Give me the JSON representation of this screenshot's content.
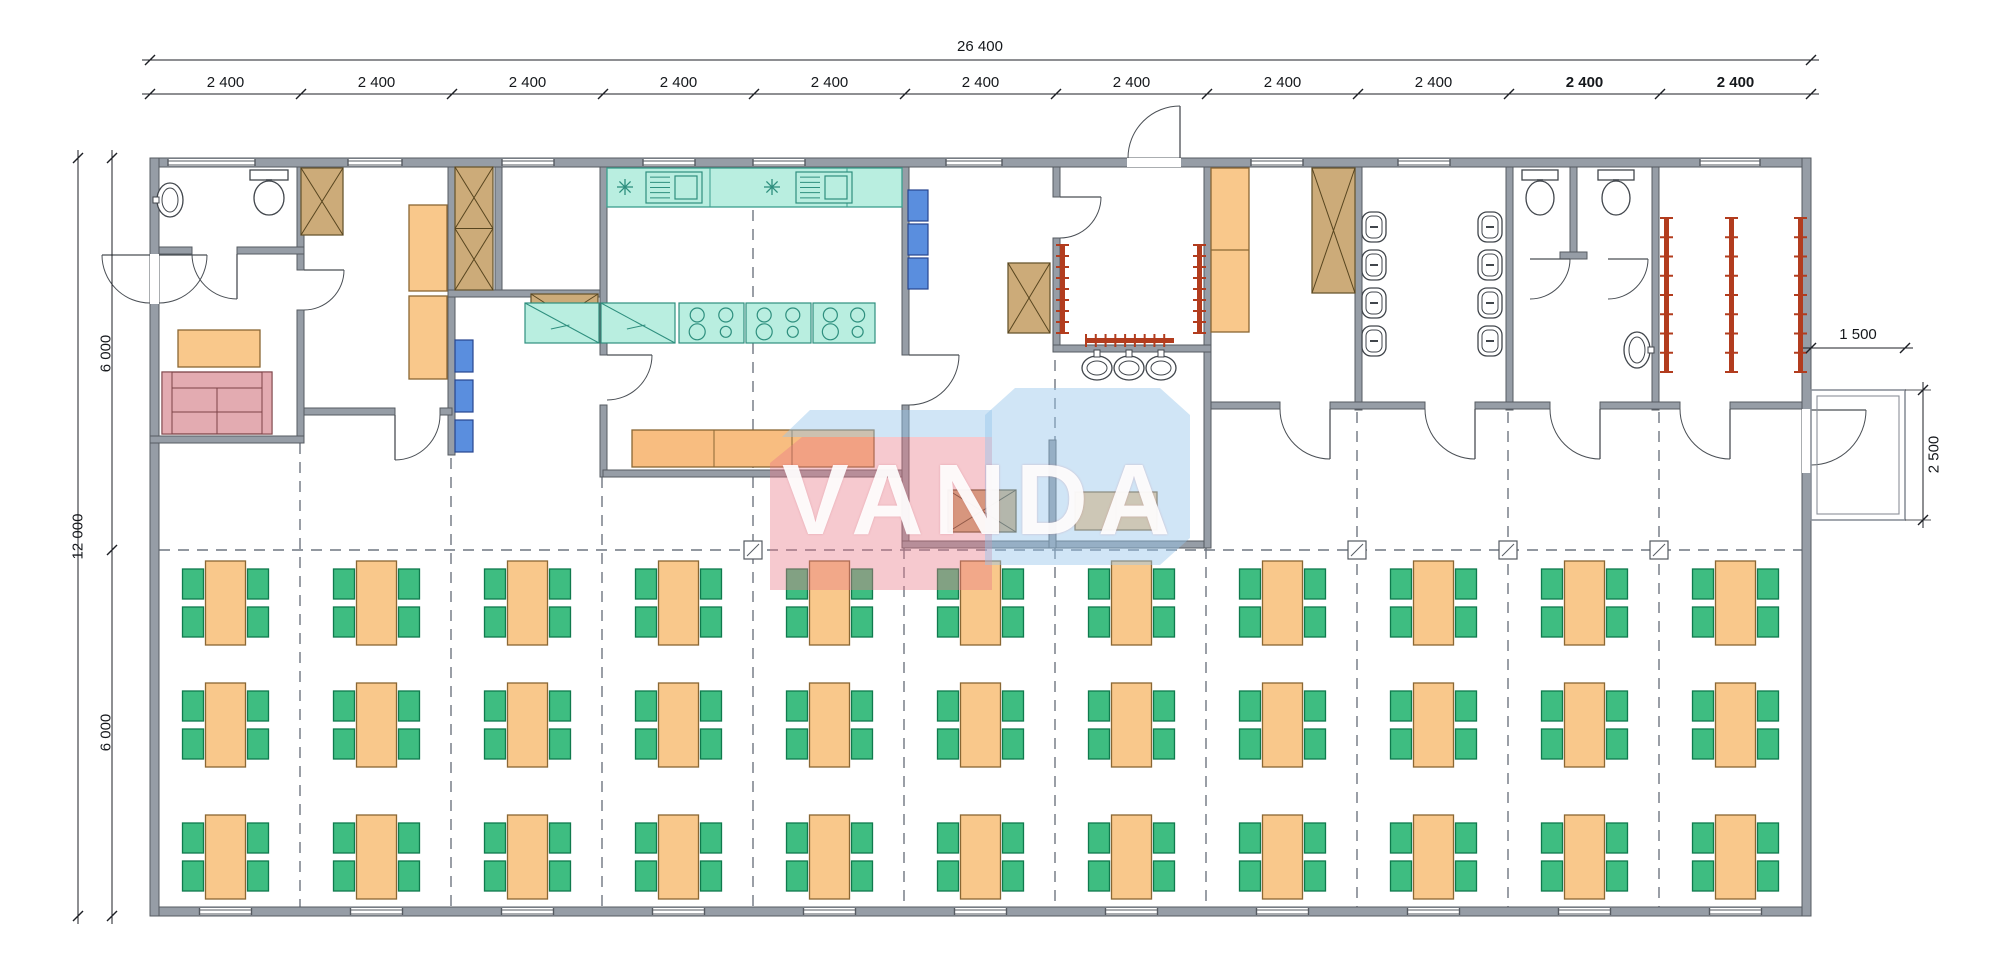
{
  "watermark": {
    "text": "VANDA",
    "pink": "rgba(233,120,135,0.40)",
    "blue": "rgba(150,198,236,0.45)"
  },
  "dimensions": {
    "overall_width_mm": "26 400",
    "overall_height_mm": "12 000",
    "height_halves": [
      "6 000",
      "6 000"
    ],
    "bays": [
      {
        "label": "2 400",
        "bold": false
      },
      {
        "label": "2 400",
        "bold": false
      },
      {
        "label": "2 400",
        "bold": false
      },
      {
        "label": "2 400",
        "bold": false
      },
      {
        "label": "2 400",
        "bold": false
      },
      {
        "label": "2 400",
        "bold": false
      },
      {
        "label": "2 400",
        "bold": false
      },
      {
        "label": "2 400",
        "bold": false
      },
      {
        "label": "2 400",
        "bold": false
      },
      {
        "label": "2 400",
        "bold": true
      },
      {
        "label": "2 400",
        "bold": true
      }
    ],
    "porch": {
      "width_mm": "1 500",
      "depth_mm": "2 500"
    }
  },
  "dining": {
    "columns": 11,
    "rows": 3,
    "tables": 33,
    "chairs_per_table": 4,
    "total_seats": 132,
    "col_start": 225.5,
    "col_step": 151,
    "row_centers": [
      603,
      725,
      857
    ]
  },
  "colors": {
    "wall": "#969da6",
    "wall_edge": "#565b62",
    "dash": "#6f7680",
    "dim": "#1c1f24",
    "table": "#f9c88b",
    "table_edge": "#8a6733",
    "chair": "#3ebd81",
    "chair_edge": "#0f7a4d",
    "kitchen": "#b9eee0",
    "kitchen_edge": "#3b9f8e",
    "cabinet": "#ccab79",
    "cabinet_edge": "#6a5831",
    "shelf": "#5a8ede",
    "shelf_edge": "#27458f",
    "sofa": "#e3abb1",
    "sofa_edge": "#7d4348",
    "rack": "#b23c1e",
    "fixture": "#41464c",
    "counter_serve": "#f8bd80"
  },
  "legend": {
    "wall": "wall",
    "window": "window",
    "door": "door-swing",
    "dash": "grid-axis-line",
    "marker": "column-marker",
    "porch": "entry-porch",
    "cabx": "storage-cabinet-icon",
    "cabxx": "tall-wardrobe-cabinet-icon",
    "tableV": "work-table-icon",
    "tableH": "serving-table-icon",
    "desk": "office-desk-icon",
    "locker2": "locker-cabinet-icon",
    "shelf": "shelf-unit-icon",
    "sofa": "sofa-icon",
    "counter": "kitchen-counter-icon",
    "sinkunit": "kitchen-sink-icon",
    "star": "light-symbol-icon",
    "fridge": "refrigerator-icon",
    "stove": "cooktop-4-burner-icon",
    "counter3": "serving-counter-icon",
    "wc": "toilet-icon",
    "sink": "washbasin-icon",
    "basin": "washbasin-icon",
    "basinV": "washbasin-icon",
    "urinal": "urinal-icon",
    "rackV": "coat-rack-icon",
    "rackH": "coat-rack-icon",
    "dining_table": "dining-table-icon",
    "dining_chair": "chair-icon"
  },
  "plan": {
    "walls": [
      [
        150,
        158,
        1661,
        9
      ],
      [
        150,
        907,
        1661,
        9
      ],
      [
        150,
        158,
        9,
        758
      ],
      [
        1802,
        158,
        9,
        758
      ],
      [
        297,
        167,
        7,
        103
      ],
      [
        297,
        310,
        7,
        133
      ],
      [
        159,
        247,
        33,
        7
      ],
      [
        237,
        247,
        67,
        7
      ],
      [
        150,
        436,
        154,
        7
      ],
      [
        448,
        167,
        7,
        288
      ],
      [
        304,
        408,
        91,
        7
      ],
      [
        440,
        408,
        12,
        7
      ],
      [
        495,
        167,
        7,
        130
      ],
      [
        448,
        290,
        157,
        7
      ],
      [
        600,
        167,
        7,
        188
      ],
      [
        600,
        405,
        7,
        72
      ],
      [
        902,
        167,
        7,
        188
      ],
      [
        902,
        405,
        7,
        143
      ],
      [
        603,
        470,
        299,
        7
      ],
      [
        902,
        541,
        309,
        7
      ],
      [
        1204,
        167,
        7,
        381
      ],
      [
        1049,
        440,
        7,
        108
      ],
      [
        1053,
        345,
        158,
        7
      ],
      [
        1053,
        167,
        7,
        30
      ],
      [
        1053,
        238,
        7,
        107
      ],
      [
        1355,
        167,
        7,
        243
      ],
      [
        1506,
        167,
        7,
        243
      ],
      [
        1570,
        167,
        7,
        92
      ],
      [
        1560,
        252,
        27,
        7
      ],
      [
        1652,
        167,
        7,
        243
      ],
      [
        1211,
        402,
        69,
        7
      ],
      [
        1330,
        402,
        95,
        7
      ],
      [
        1475,
        402,
        75,
        7
      ],
      [
        1600,
        402,
        80,
        7
      ],
      [
        1730,
        402,
        72,
        7
      ]
    ],
    "windows_top": [
      [
        168,
        87
      ],
      [
        348,
        54
      ],
      [
        502,
        52
      ],
      [
        643,
        52
      ],
      [
        753,
        52
      ],
      [
        946,
        56
      ],
      [
        1251,
        52
      ],
      [
        1398,
        52
      ],
      [
        1700,
        60
      ]
    ],
    "gaps": [
      [
        150,
        254,
        9,
        50
      ],
      [
        1802,
        409,
        9,
        64
      ],
      [
        1127,
        158,
        54,
        9
      ]
    ],
    "dashes_v": [
      [
        300,
        443,
        907
      ],
      [
        451,
        420,
        907
      ],
      [
        602,
        477,
        907
      ],
      [
        753,
        210,
        470
      ],
      [
        753,
        477,
        907
      ],
      [
        904,
        548,
        907
      ],
      [
        1055,
        360,
        535
      ],
      [
        1055,
        548,
        907
      ],
      [
        1206,
        548,
        907
      ],
      [
        1357,
        412,
        907
      ],
      [
        1508,
        412,
        907
      ],
      [
        1659,
        412,
        907
      ]
    ],
    "dash_h": [
      550,
      159,
      1802
    ],
    "markers": [
      [
        753,
        550
      ],
      [
        1357,
        550
      ],
      [
        1508,
        550
      ],
      [
        1659,
        550
      ]
    ],
    "doors": [
      {
        "h": [
          159,
          255
        ],
        "a": [
          207,
          255
        ],
        "b": [
          159,
          303
        ],
        "s": 1
      },
      {
        "h": [
          150,
          255
        ],
        "a": [
          102,
          255
        ],
        "b": [
          150,
          303
        ],
        "s": 0
      },
      {
        "h": [
          237,
          254
        ],
        "a": [
          237,
          299
        ],
        "b": [
          192,
          254
        ],
        "s": 1
      },
      {
        "h": [
          304,
          270
        ],
        "a": [
          344,
          270
        ],
        "b": [
          304,
          310
        ],
        "s": 1
      },
      {
        "h": [
          607,
          355
        ],
        "a": [
          652,
          355
        ],
        "b": [
          607,
          400
        ],
        "s": 1
      },
      {
        "h": [
          909,
          355
        ],
        "a": [
          959,
          355
        ],
        "b": [
          909,
          405
        ],
        "s": 1
      },
      {
        "h": [
          1060,
          197
        ],
        "a": [
          1101,
          197
        ],
        "b": [
          1060,
          238
        ],
        "s": 1
      },
      {
        "h": [
          1180,
          158
        ],
        "a": [
          1180,
          106
        ],
        "b": [
          1128,
          158
        ],
        "s": 0
      },
      {
        "h": [
          1330,
          409
        ],
        "a": [
          1330,
          459
        ],
        "b": [
          1280,
          409
        ],
        "s": 1
      },
      {
        "h": [
          1475,
          409
        ],
        "a": [
          1475,
          459
        ],
        "b": [
          1425,
          409
        ],
        "s": 1
      },
      {
        "h": [
          1600,
          409
        ],
        "a": [
          1600,
          459
        ],
        "b": [
          1550,
          409
        ],
        "s": 1
      },
      {
        "h": [
          1730,
          409
        ],
        "a": [
          1730,
          459
        ],
        "b": [
          1680,
          409
        ],
        "s": 1
      },
      {
        "h": [
          1811,
          410
        ],
        "a": [
          1866,
          410
        ],
        "b": [
          1811,
          465
        ],
        "s": 1
      },
      {
        "h": [
          1530,
          259
        ],
        "a": [
          1570,
          259
        ],
        "b": [
          1530,
          299
        ],
        "s": 1
      },
      {
        "h": [
          1608,
          259
        ],
        "a": [
          1648,
          259
        ],
        "b": [
          1608,
          299
        ],
        "s": 1
      },
      {
        "h": [
          395,
          415
        ],
        "a": [
          395,
          460
        ],
        "b": [
          440,
          415
        ],
        "s": 0
      }
    ],
    "furniture": [
      {
        "t": "sink",
        "x": 157,
        "y": 183,
        "w": 26,
        "h": 34
      },
      {
        "t": "wc",
        "x": 250,
        "y": 170,
        "w": 38,
        "h": 46
      },
      {
        "t": "desk",
        "x": 178,
        "y": 330,
        "w": 82,
        "h": 37
      },
      {
        "t": "sofa",
        "x": 162,
        "y": 372,
        "w": 110,
        "h": 62
      },
      {
        "t": "cabx",
        "x": 301,
        "y": 168,
        "w": 42,
        "h": 67
      },
      {
        "t": "tableV",
        "x": 409,
        "y": 205,
        "w": 38,
        "h": 86
      },
      {
        "t": "tableV",
        "x": 409,
        "y": 296,
        "w": 38,
        "h": 83
      },
      {
        "t": "cabxx",
        "x": 455,
        "y": 167,
        "w": 38,
        "h": 123
      },
      {
        "t": "shelf",
        "x": 455,
        "y": 340,
        "w": 18,
        "h": 32
      },
      {
        "t": "shelf",
        "x": 455,
        "y": 380,
        "w": 18,
        "h": 32
      },
      {
        "t": "shelf",
        "x": 455,
        "y": 420,
        "w": 18,
        "h": 32
      },
      {
        "t": "cabx",
        "x": 531,
        "y": 294,
        "w": 67,
        "h": 43
      },
      {
        "t": "counter",
        "x": 607,
        "y": 168,
        "w": 295,
        "h": 39
      },
      {
        "t": "star",
        "x": 617,
        "y": 179,
        "w": 16,
        "h": 16
      },
      {
        "t": "sinkunit",
        "x": 646,
        "y": 172,
        "w": 56,
        "h": 31
      },
      {
        "t": "star",
        "x": 764,
        "y": 179,
        "w": 16,
        "h": 16
      },
      {
        "t": "sinkunit",
        "x": 796,
        "y": 172,
        "w": 56,
        "h": 31
      },
      {
        "t": "fridge",
        "x": 525,
        "y": 303,
        "w": 74,
        "h": 40
      },
      {
        "t": "fridge",
        "x": 601,
        "y": 303,
        "w": 74,
        "h": 40
      },
      {
        "t": "stove",
        "x": 679,
        "y": 303,
        "w": 65,
        "h": 40
      },
      {
        "t": "stove",
        "x": 746,
        "y": 303,
        "w": 65,
        "h": 40
      },
      {
        "t": "stove",
        "x": 813,
        "y": 303,
        "w": 62,
        "h": 40
      },
      {
        "t": "counter3",
        "x": 632,
        "y": 430,
        "w": 242,
        "h": 37
      },
      {
        "t": "shelf",
        "x": 908,
        "y": 190,
        "w": 20,
        "h": 31
      },
      {
        "t": "shelf",
        "x": 908,
        "y": 224,
        "w": 20,
        "h": 31
      },
      {
        "t": "shelf",
        "x": 908,
        "y": 258,
        "w": 20,
        "h": 31
      },
      {
        "t": "cabx",
        "x": 1008,
        "y": 263,
        "w": 42,
        "h": 70
      },
      {
        "t": "cabx",
        "x": 948,
        "y": 490,
        "w": 68,
        "h": 42
      },
      {
        "t": "tableH",
        "x": 1075,
        "y": 492,
        "w": 82,
        "h": 38
      },
      {
        "t": "basin",
        "x": 1082,
        "y": 354,
        "w": 30,
        "h": 24
      },
      {
        "t": "basin",
        "x": 1114,
        "y": 354,
        "w": 30,
        "h": 24
      },
      {
        "t": "basin",
        "x": 1146,
        "y": 354,
        "w": 30,
        "h": 24
      },
      {
        "t": "locker2",
        "x": 1211,
        "y": 168,
        "w": 38,
        "h": 164
      },
      {
        "t": "cabx",
        "x": 1312,
        "y": 168,
        "w": 43,
        "h": 125
      },
      {
        "t": "urinal",
        "x": 1362,
        "y": 212,
        "w": 24,
        "h": 30
      },
      {
        "t": "urinal",
        "x": 1362,
        "y": 250,
        "w": 24,
        "h": 30
      },
      {
        "t": "urinal",
        "x": 1362,
        "y": 288,
        "w": 24,
        "h": 30
      },
      {
        "t": "urinal",
        "x": 1362,
        "y": 326,
        "w": 24,
        "h": 30
      },
      {
        "t": "urinal",
        "x": 1478,
        "y": 212,
        "w": 24,
        "h": 30
      },
      {
        "t": "urinal",
        "x": 1478,
        "y": 250,
        "w": 24,
        "h": 30
      },
      {
        "t": "urinal",
        "x": 1478,
        "y": 288,
        "w": 24,
        "h": 30
      },
      {
        "t": "urinal",
        "x": 1478,
        "y": 326,
        "w": 24,
        "h": 30
      },
      {
        "t": "wc",
        "x": 1522,
        "y": 170,
        "w": 36,
        "h": 46
      },
      {
        "t": "wc",
        "x": 1598,
        "y": 170,
        "w": 36,
        "h": 46
      },
      {
        "t": "basinV",
        "x": 1624,
        "y": 332,
        "w": 26,
        "h": 36
      },
      {
        "t": "rackV",
        "x": 1664,
        "y": 218,
        "w": 5,
        "h": 154
      },
      {
        "t": "rackV",
        "x": 1729,
        "y": 218,
        "w": 5,
        "h": 154
      },
      {
        "t": "rackV",
        "x": 1798,
        "y": 218,
        "w": 5,
        "h": 154
      },
      {
        "t": "rackV",
        "x": 1060,
        "y": 245,
        "w": 5,
        "h": 88
      },
      {
        "t": "rackV",
        "x": 1197,
        "y": 245,
        "w": 5,
        "h": 88
      },
      {
        "t": "rackH",
        "x": 1086,
        "y": 338,
        "w": 88,
        "h": 5
      }
    ],
    "porch": [
      1811,
      390,
      94,
      130
    ],
    "dims": {
      "top_total_y": 60,
      "top_bay_y": 94,
      "left_total_x": 78,
      "left_half_x": 112,
      "bldg": [
        150,
        1811,
        158,
        916
      ],
      "half_break_y": 550,
      "porch_w_line": [
        1803,
        1913,
        348
      ],
      "porch_w_ticks": [
        1811,
        1905
      ],
      "porch_d_line": [
        1923,
        382,
        528
      ],
      "porch_d_ticks": [
        390,
        520
      ]
    }
  }
}
